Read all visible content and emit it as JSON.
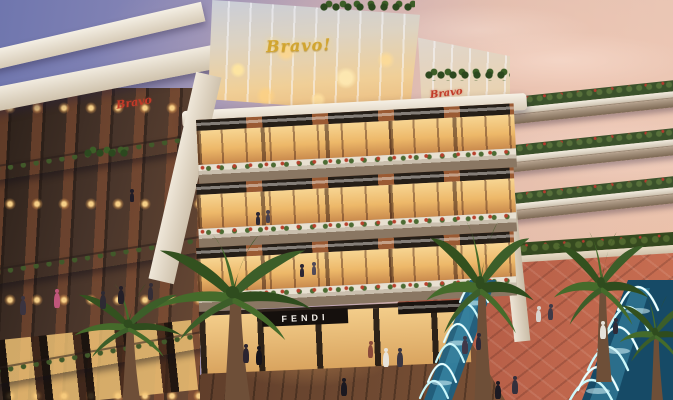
{
  "scene": {
    "type": "architectural-rendering",
    "description": "Dusk exterior rendering of a multi-level open-air shopping mall with glass atrium, tiered planter bridges, palm trees, terracotta plaza and illuminated fountain pools",
    "time_of_day": "dusk"
  },
  "signs": {
    "atrium_logo": "Bravo!",
    "left_wing_logo": "Bravo",
    "right_wing_logo": "Bravo",
    "storefront_brand": "FENDI"
  },
  "palette": {
    "sky_top_left": "#6f76ae",
    "sky_right": "#e8c9b8",
    "cornice_cream": "#efe7da",
    "brick": "#98582f",
    "sign_band_dark": "#241d16",
    "window_glow": "#f6c87d",
    "gold_logo": "#d2a52f",
    "red_logo": "#c23a28",
    "paving_terracotta": "#b05947",
    "deck_wood": "#6b4730",
    "pool_water": "#1c5e7e",
    "fountain_jet": "#c9f7fb",
    "palm_frond": "#3f6130"
  }
}
